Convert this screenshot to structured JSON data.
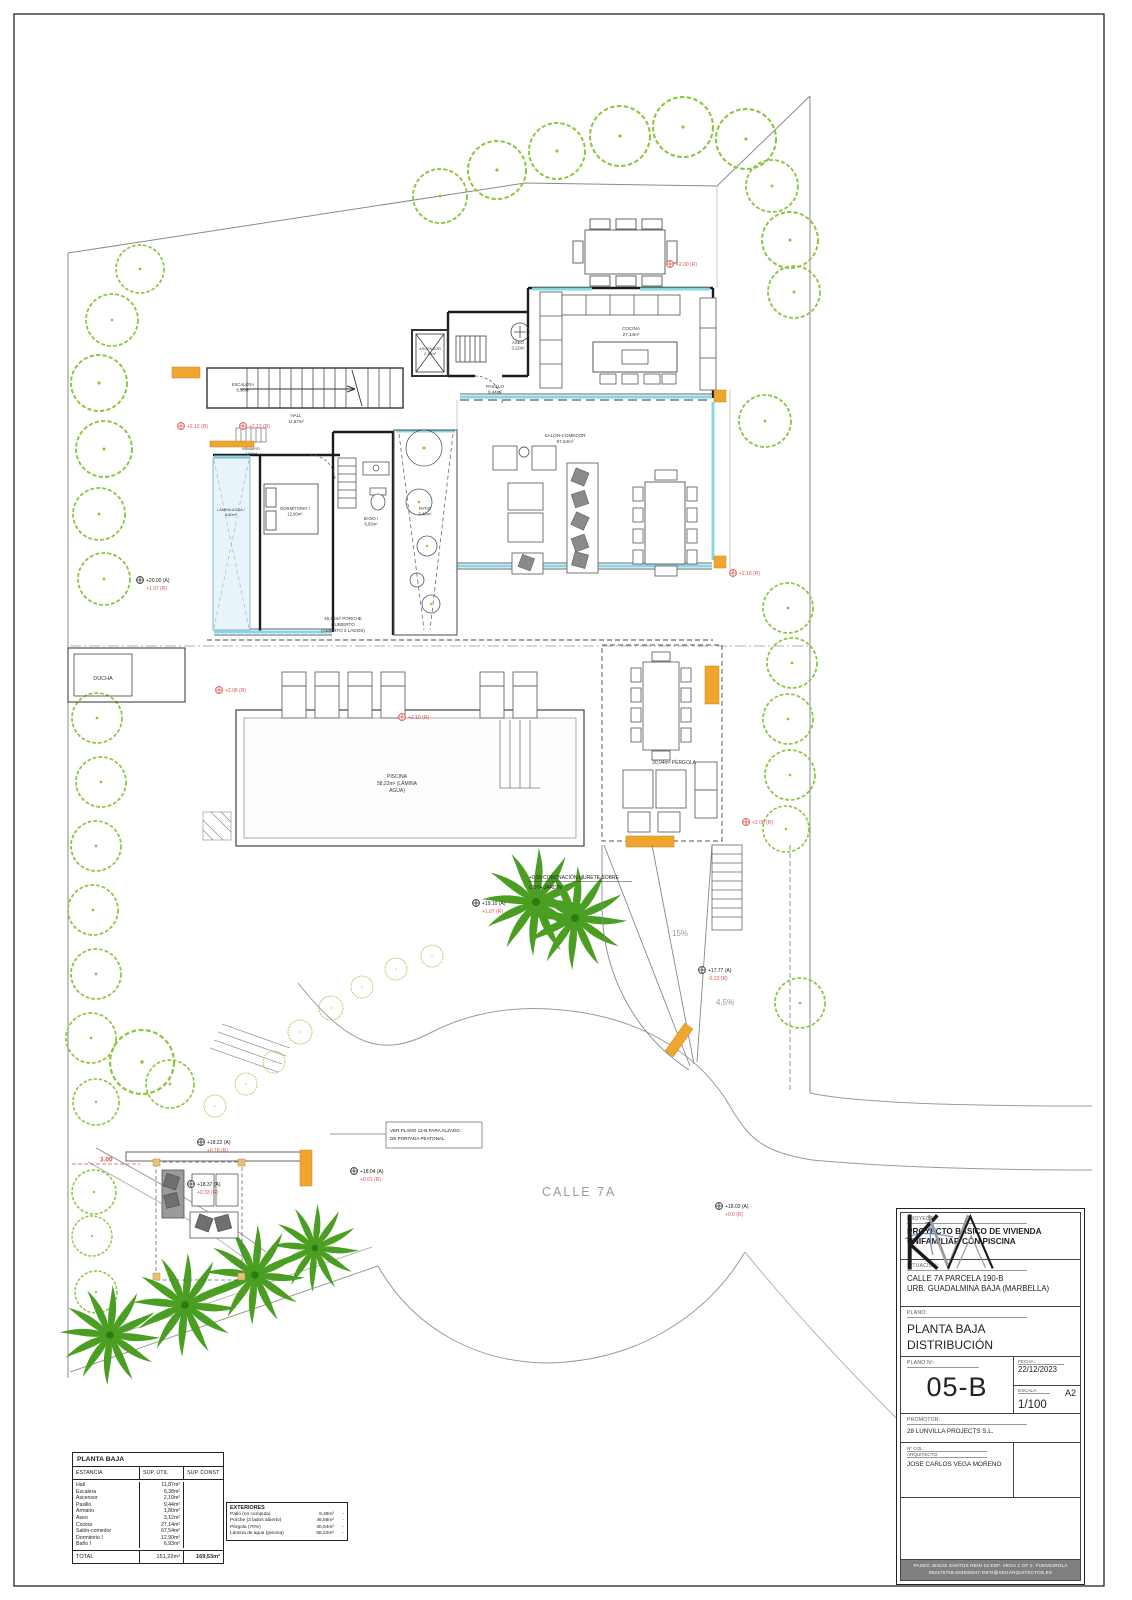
{
  "plan": {
    "street_label": "CALLE 7A",
    "slope_ramp": "15%",
    "slope_drive": "4,5%",
    "dim_3m": "3.00",
    "notes": {
      "murete_1": "+0,50 CORONACIÓN MURETE SOBRE",
      "murete_2": "COTA JARDÍN",
      "gate_note_1": "VER PLANO 12-B PARA ALZADO",
      "gate_note_2": "DE PORTADA PEATONAL"
    },
    "rooms": {
      "escalera": {
        "name": "ESCALERA",
        "area": "6,38m²"
      },
      "hall": {
        "name": "HALL",
        "area": "11,87m²"
      },
      "ascensor": {
        "name": "ASCENSOR",
        "area": "2,10m²"
      },
      "aseo": {
        "name": "ASEO",
        "area": "3,12m²"
      },
      "cocina": {
        "name": "COCINA",
        "area": "27,14m²"
      },
      "pasillo": {
        "name": "PASILLO",
        "area": "9,44m²"
      },
      "salon": {
        "name": "SALÓN-COMEDOR",
        "area": "67,54m²"
      },
      "dormitorio": {
        "name": "DORMITORIO I",
        "area": "12,90m²"
      },
      "bano": {
        "name": "BAÑO I",
        "area": "6,93m²"
      },
      "armario": {
        "name": "ARMARIO",
        "area": "1,80m²"
      },
      "lamina": {
        "name": "LÁMINA AGUA /",
        "area": "8,80m²"
      },
      "patio": {
        "name": "PATIO",
        "area": "6,48m²"
      },
      "ducha": {
        "name": "DUCHA"
      },
      "piscina_1": "PISCINA",
      "piscina_2": "58,22m² (LÁMINA",
      "piscina_3": "AGUA)",
      "pergola": "30,94m² PÉRGOLA",
      "porche_1": "46,58m² PORCHE",
      "porche_2": "CUBIERTO",
      "porche_3": "(ABIERTO 3 LADOS)"
    },
    "markers": {
      "m_200": {
        "r": "+2.00 (R)"
      },
      "m_212a": {
        "r": "+2.12 (R)"
      },
      "m_212b": {
        "r": "+2.12 (R)"
      },
      "m_2000": {
        "a": "+20.00 (A)",
        "r": "+1.97 (R)"
      },
      "m_208a": {
        "r": "+2.08 (R)"
      },
      "m_210a": {
        "r": "+2.10 (R)"
      },
      "m_210b": {
        "r": "+2.10 (R)"
      },
      "m_208b": {
        "r": "+2.08 (R)"
      },
      "m_1910": {
        "a": "+19.10 (A)",
        "r": "+1.07 (R)"
      },
      "m_1777": {
        "a": "+17.77 (A)",
        "r": "-0.23 (R)"
      },
      "m_1822": {
        "a": "+18.22 (A)",
        "r": "+0.18 (R)"
      },
      "m_1804": {
        "a": "+18.04 (A)",
        "r": "+0.01 (R)"
      },
      "m_1837": {
        "a": "+18.37 (A)",
        "r": "+0.33 (R)"
      },
      "m_1803": {
        "a": "+18.03 (A)",
        "r": "+0.0 (R)"
      }
    }
  },
  "tables": {
    "planta_baja": {
      "title": "PLANTA BAJA",
      "headers": [
        "ESTANCIA",
        "SUP. ÚTIL",
        "SUP. CONST"
      ],
      "rows": [
        [
          "Hall",
          "11,87m²",
          ""
        ],
        [
          "Escalera",
          "6,38m²",
          ""
        ],
        [
          "Ascensor",
          "2,10m²",
          ""
        ],
        [
          "Pasillo",
          "9,44m²",
          ""
        ],
        [
          "Armario",
          "1,80m²",
          ""
        ],
        [
          "Aseo",
          "3,12m²",
          ""
        ],
        [
          "Cocina",
          "27,14m²",
          ""
        ],
        [
          "Salón-comedor",
          "67,54m²",
          ""
        ],
        [
          "Dormitorio I",
          "12,90m²",
          ""
        ],
        [
          "Baño I",
          "6,93m²",
          ""
        ]
      ],
      "total": [
        "TOTAL",
        "151,22m²",
        "169,53m²"
      ]
    },
    "exteriores": {
      "title": "EXTERIORES",
      "rows": [
        [
          "Patio (no computa)",
          "6,48m²",
          "-"
        ],
        [
          "Porche (3 lados abierto)",
          "46,58m²",
          "-"
        ],
        [
          "Pérgola (70%)",
          "30,94m²",
          "-"
        ],
        [
          "Lámina de agua (piscina)",
          "58,22m²",
          "-"
        ]
      ]
    }
  },
  "titleblock": {
    "proyecto_label": "PROYECTO:",
    "proyecto_1": "PROYECTO BÁSICO DE VIVIENDA",
    "proyecto_2": "UNIFAMILIAR CON PISCINA",
    "situacion_label": "SITUACIÓN:",
    "situacion_1": "CALLE 7A PARCELA 190-B",
    "situacion_2": "URB. GUADALMINA BAJA (MARBELLA)",
    "plano_label": "PLANO:",
    "plano_1": "PLANTA BAJA",
    "plano_2": "DISTRIBUCIÓN",
    "plano_num_label": "PLANO Nº:",
    "plano_num": "05-B",
    "fecha_label": "FECHA:",
    "fecha": "22/12/2023",
    "escala_label": "ESCALA:",
    "formato": "A2",
    "escala": "1/100",
    "promotor_label": "PROMOTOR:",
    "promotor": "28 LUNVILLA PROJECTS S.L.",
    "col_label": "Nº COL.:",
    "arquitecto_label": "ARQUITECTO:",
    "arquitecto": "JOSE CARLOS VEGA MORENO",
    "footer_1": "PASEO JESÚS SANTOS REIN 15 EDF. VEGA 1 OF 2. FUENGIROLA",
    "footer_2": "952476759-634506047-INFO@VEGARQUITECTOS.ES"
  }
}
